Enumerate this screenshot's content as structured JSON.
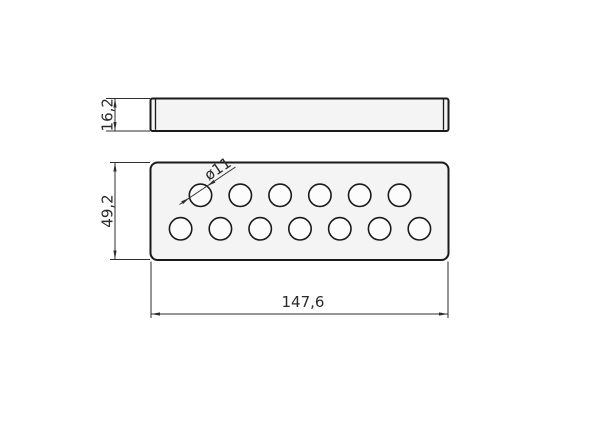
{
  "drawing": {
    "dimensions": {
      "side_view_height": "16,2",
      "top_view_height": "49,2",
      "top_view_width": "147,6",
      "hole_diameter": "ø11"
    },
    "holes": {
      "total": 13,
      "top_row_count": 6,
      "bottom_row_count": 7
    },
    "colors": {
      "background": "#ffffff",
      "part_fill": "#f4f4f4",
      "outline": "#1a1a1a",
      "dimension": "#2e2e2e"
    }
  }
}
